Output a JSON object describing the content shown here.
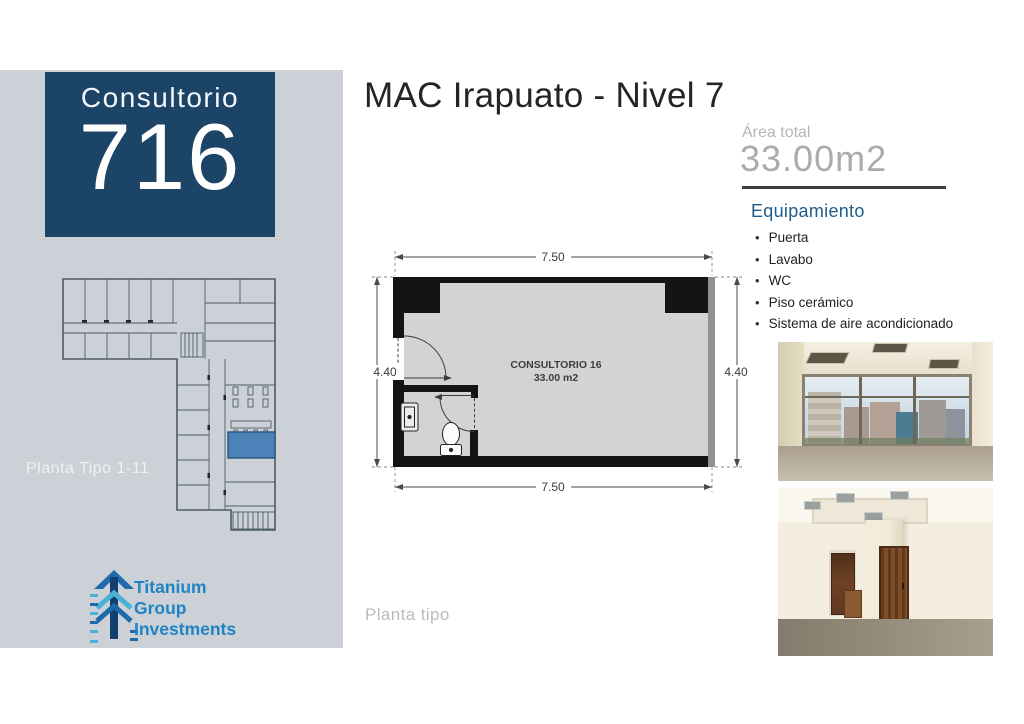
{
  "slide": {
    "title": "MAC Irapuato - Nivel 7"
  },
  "unit_card": {
    "label": "Consultorio",
    "number": "716"
  },
  "mini_plan": {
    "caption": "Planta Tipo 1-11"
  },
  "logo": {
    "line1": "Titanium",
    "line2": "Group",
    "line3": "Investments"
  },
  "area": {
    "label": "Área total",
    "value": "33.00m2"
  },
  "equipment": {
    "heading": "Equipamiento",
    "items": [
      "Puerta",
      "Lavabo",
      "WC",
      "Piso cerámico",
      "Sistema de aire acondicionado"
    ]
  },
  "unit_plan": {
    "room_name": "CONSULTORIO 16",
    "room_area": "33.00 m2",
    "dims": {
      "top": "7.50",
      "bottom": "7.50",
      "left": "4.40",
      "right": "4.40"
    },
    "caption": "Planta tipo"
  },
  "colors": {
    "brand_navy": "#1c4467",
    "accent_blue": "#1d5c8c",
    "highlight_room": "#4d82b8",
    "logo_blue": "#2084c4",
    "sidebar_gray": "#cbd1d6"
  }
}
